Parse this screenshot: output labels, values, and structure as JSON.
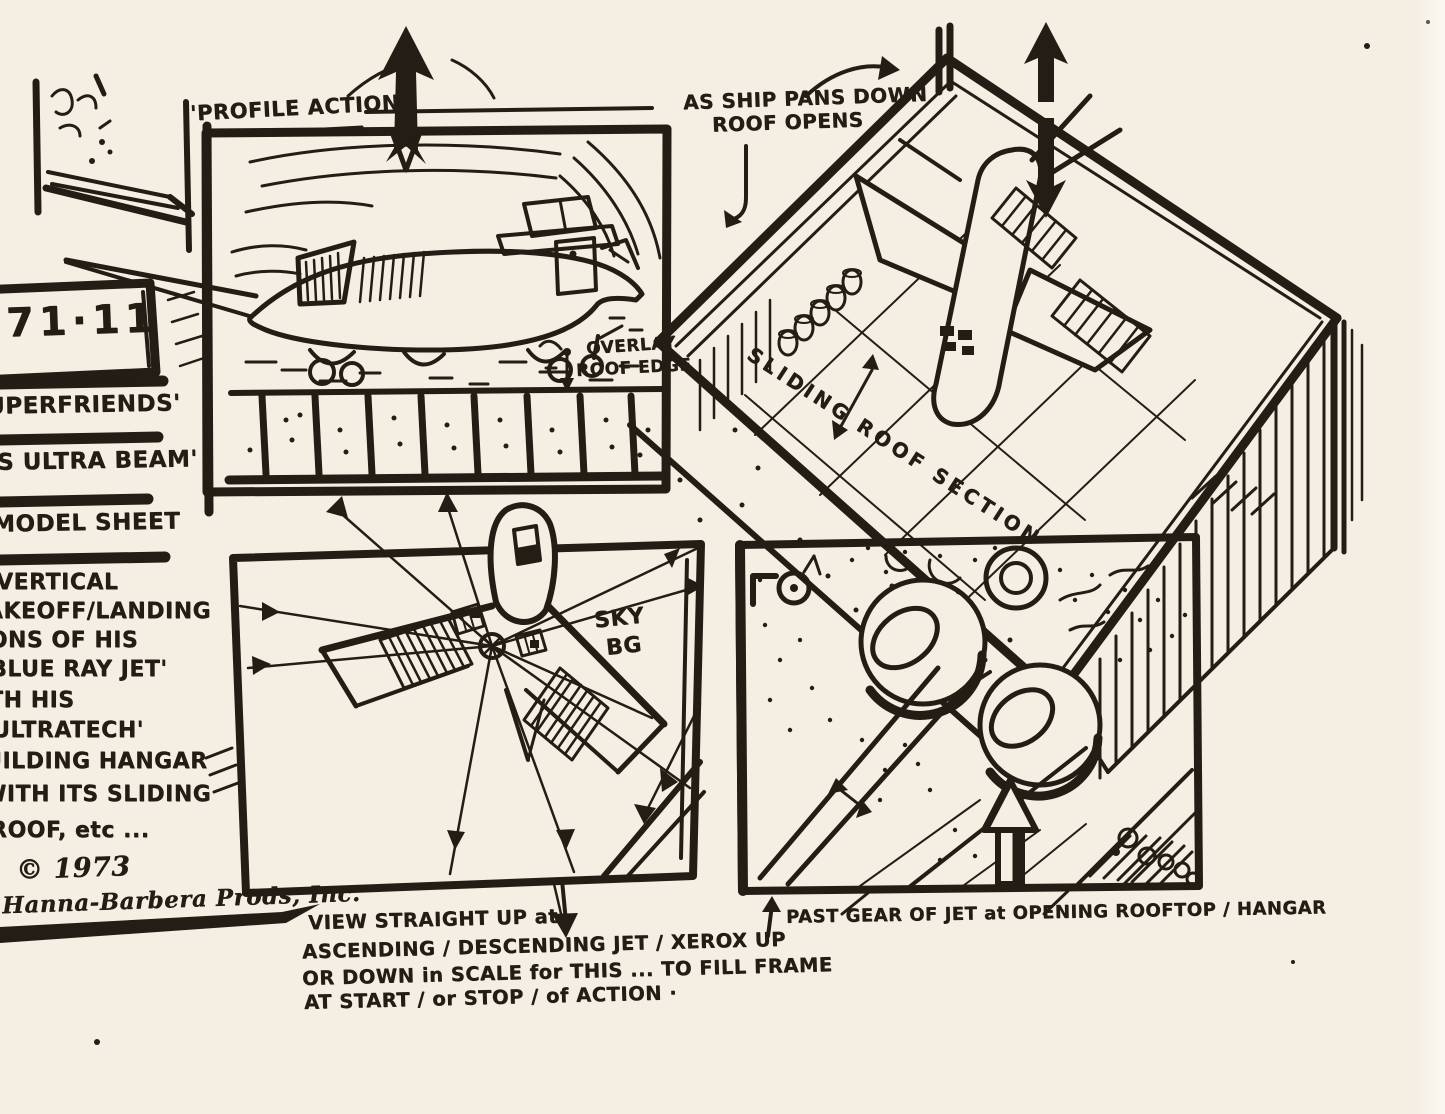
{
  "page": {
    "background": "#f4efe2",
    "ink": "#241d15"
  },
  "margin": {
    "production_code": "71·11",
    "title_lines": [
      "UPERFRIENDS'",
      "IS ULTRA BEAM'",
      "MODEL SHEET"
    ],
    "description_lines": [
      "VERTICAL",
      "TAKEOFF/LANDING",
      "IONS OF HIS",
      "BLUE RAY JET'",
      "TH HIS",
      "ULTRATECH'",
      "UILDING HANGAR",
      "WITH ITS SLIDING",
      "ROOF, etc ..."
    ],
    "copyright_year": "© 1973",
    "copyright_name": "Hanna-Barbera Prods, Inc."
  },
  "panel1": {
    "title": "'PROFILE ACTION",
    "note_line1": "OVERLAY",
    "note_line2": "ROOF EDGE"
  },
  "panel2": {
    "note_line1": "AS SHIP PANS DOWN",
    "note_line2": "ROOF OPENS",
    "roof_label": "SLIDING ROOF SECTION"
  },
  "panel3": {
    "sky_label_line1": "SKY",
    "sky_label_line2": "BG",
    "caption_lines": [
      "VIEW STRAIGHT UP at",
      "ASCENDING / DESCENDING JET / XEROX UP",
      "OR DOWN in SCALE for THIS ... TO FILL FRAME",
      "AT START / or STOP / of ACTION ·"
    ]
  },
  "panel4": {
    "caption": "PAST GEAR OF JET at OPENING ROOFTOP / HANGAR"
  }
}
